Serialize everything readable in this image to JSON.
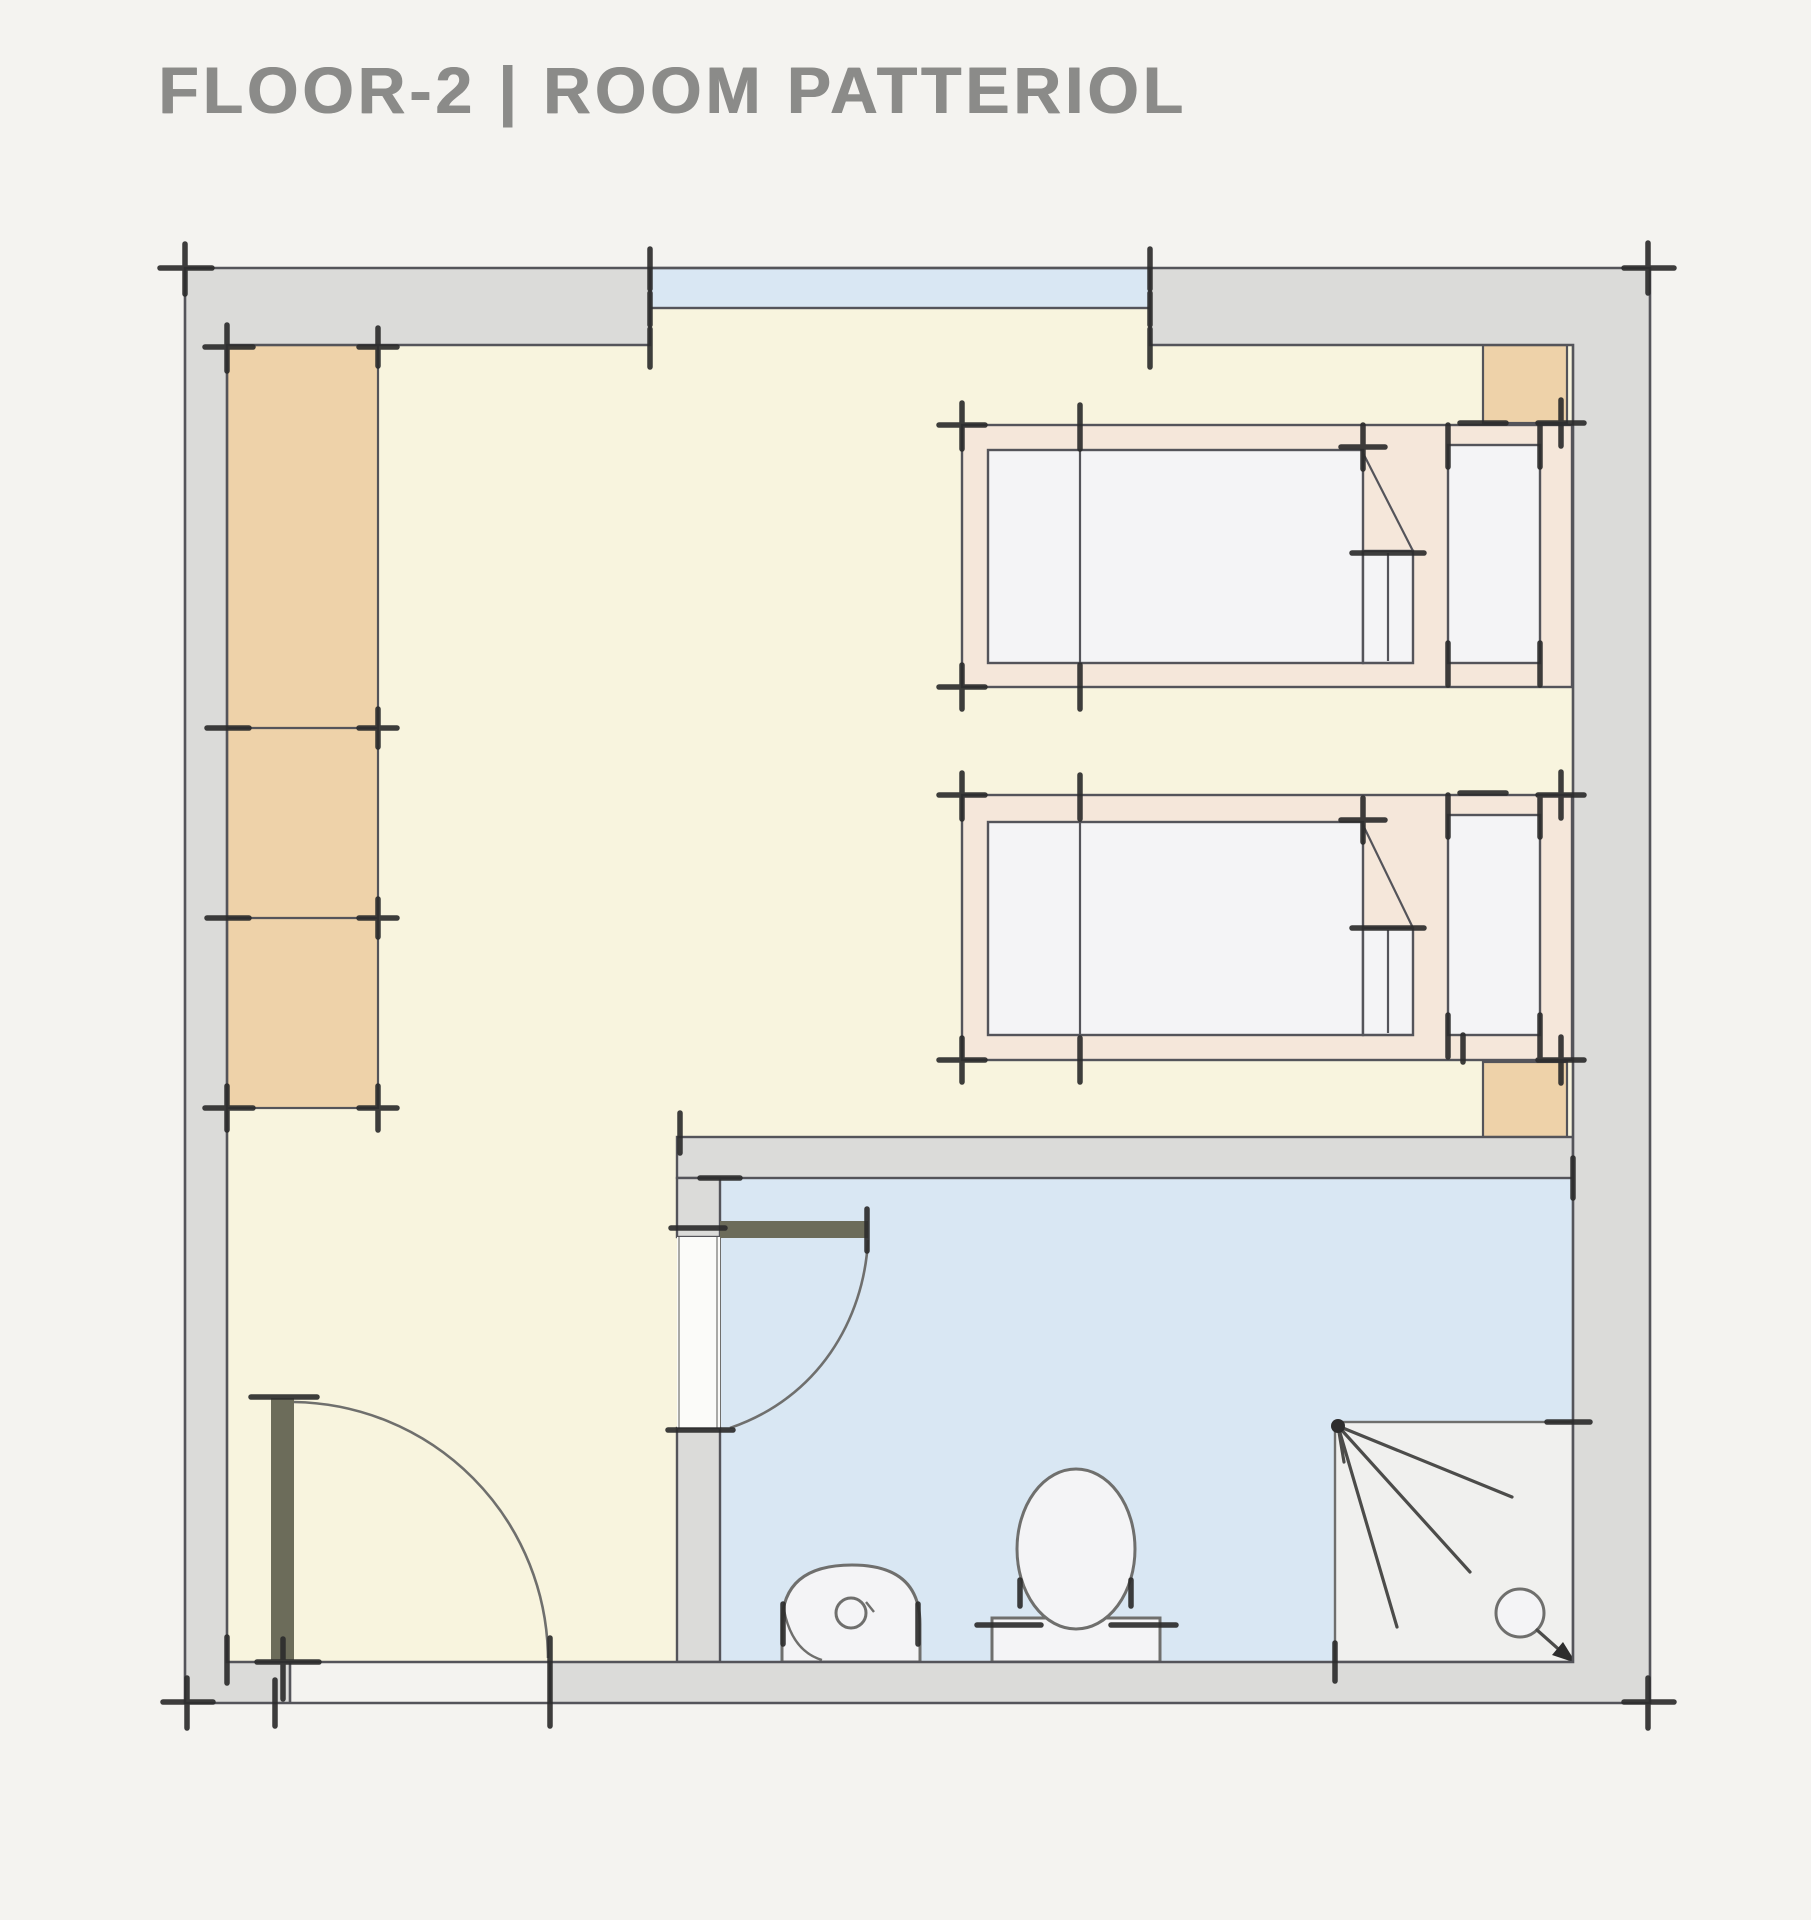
{
  "title": "FLOOR-2 | ROOM PATTERIOL",
  "plan": {
    "floor": "FLOOR-2",
    "room": "ROOM PATTERIOL",
    "rooms": [
      "main-room",
      "bathroom"
    ],
    "features": [
      "window",
      "wardrobe",
      "bed-1",
      "bed-2",
      "entry-door",
      "bathroom-door",
      "sink",
      "toilet",
      "shower"
    ]
  },
  "colors": {
    "paper": "#f4f3f0",
    "wall_fill": "#dbdbd9",
    "line": "#54545a",
    "room_floor": "#f8f4de",
    "water_blue": "#d9e7f3",
    "wardrobe_tan": "#eed2a9",
    "bed_frame": "#f5e7da",
    "mattress_white": "#f4f4f6",
    "shower_floor": "#f0f0ee",
    "door_leaf": "#6c6c5a",
    "gap_white": "#fbfbf9",
    "tick": "#2d2d2d",
    "fixture_line": "#6f6f6d",
    "spray_line": "#4c4c4a",
    "title_text": "#8b8b89"
  }
}
